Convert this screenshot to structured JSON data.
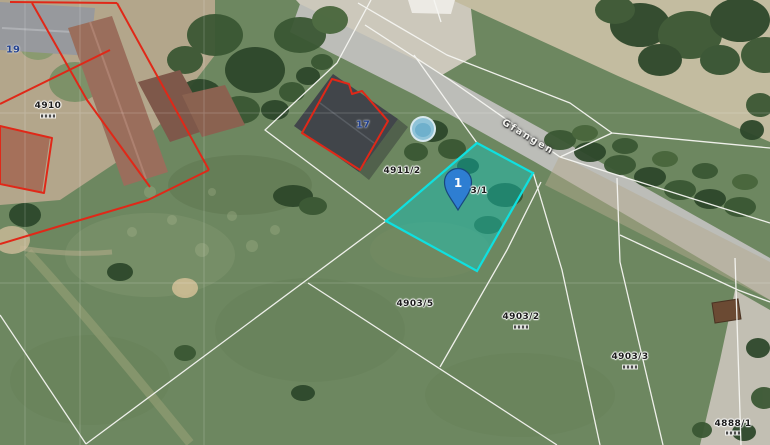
{
  "map": {
    "street_label": "Gfangen",
    "marker_number": "1",
    "labels": {
      "house_19": "19",
      "house_17": "17",
      "parcel_4910": "4910",
      "parcel_4911_2": "4911/2",
      "selected_parcel_partial": "3/1",
      "parcel_4903_5": "4903/5",
      "parcel_4903_2": "4903/2",
      "parcel_4903_3": "4903/3",
      "parcel_4888_1": "4888/1"
    },
    "colors": {
      "selection_fill": "#00d2cd",
      "selection_border": "#0fe0e0",
      "cadastral_red": "#e02818",
      "parcel_line_white": "#f6f6f2",
      "marker_blue": "#2e7ed2",
      "house_number_blue": "#22418f"
    }
  }
}
